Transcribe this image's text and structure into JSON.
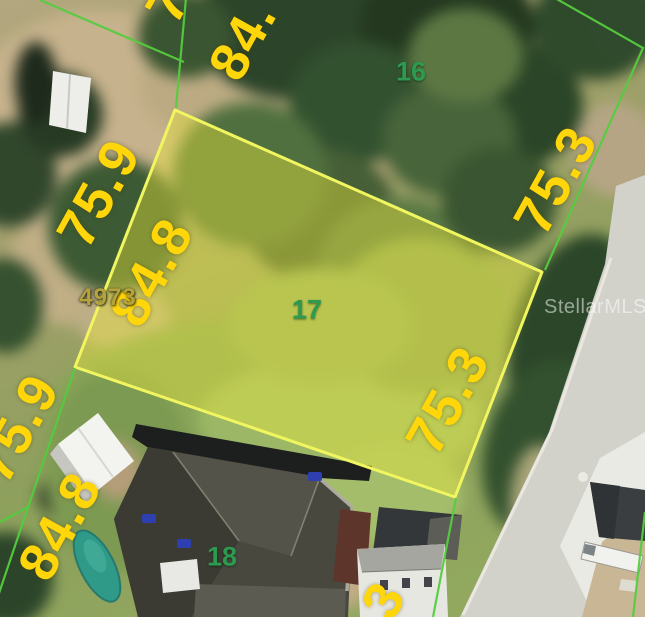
{
  "map": {
    "watermark_text": "StellarMLS",
    "parcel_account_number": "4973",
    "highlighted_lot": "17",
    "lot_numbers": {
      "lot16": "16",
      "lot17": "17",
      "lot18": "18"
    },
    "dimensions": {
      "top_edge_partial": "7",
      "top_84": "84.",
      "left_upper_75_9": "75.9",
      "inner_left_84_8": "84.8",
      "right_outer_75_3": "75.3",
      "right_inner_75_3": "75.3",
      "left_lower_75_9": "75.9",
      "left_lower_84_8": "84.8",
      "bottom_partial_3": "3"
    },
    "colors": {
      "dimension_text": "#ffd60a",
      "lot_number_text": "#2d9a50",
      "boundary_line_green": "#55cc3f",
      "parcel_outline_yellow": "#f1f55f",
      "parcel_fill_yellow": "rgba(237,230,60,0.42)",
      "parcel_number_text": "#b5a33c",
      "watermark": "rgba(255,255,255,0.52)",
      "road_pavement": "#d2d2cb"
    }
  }
}
